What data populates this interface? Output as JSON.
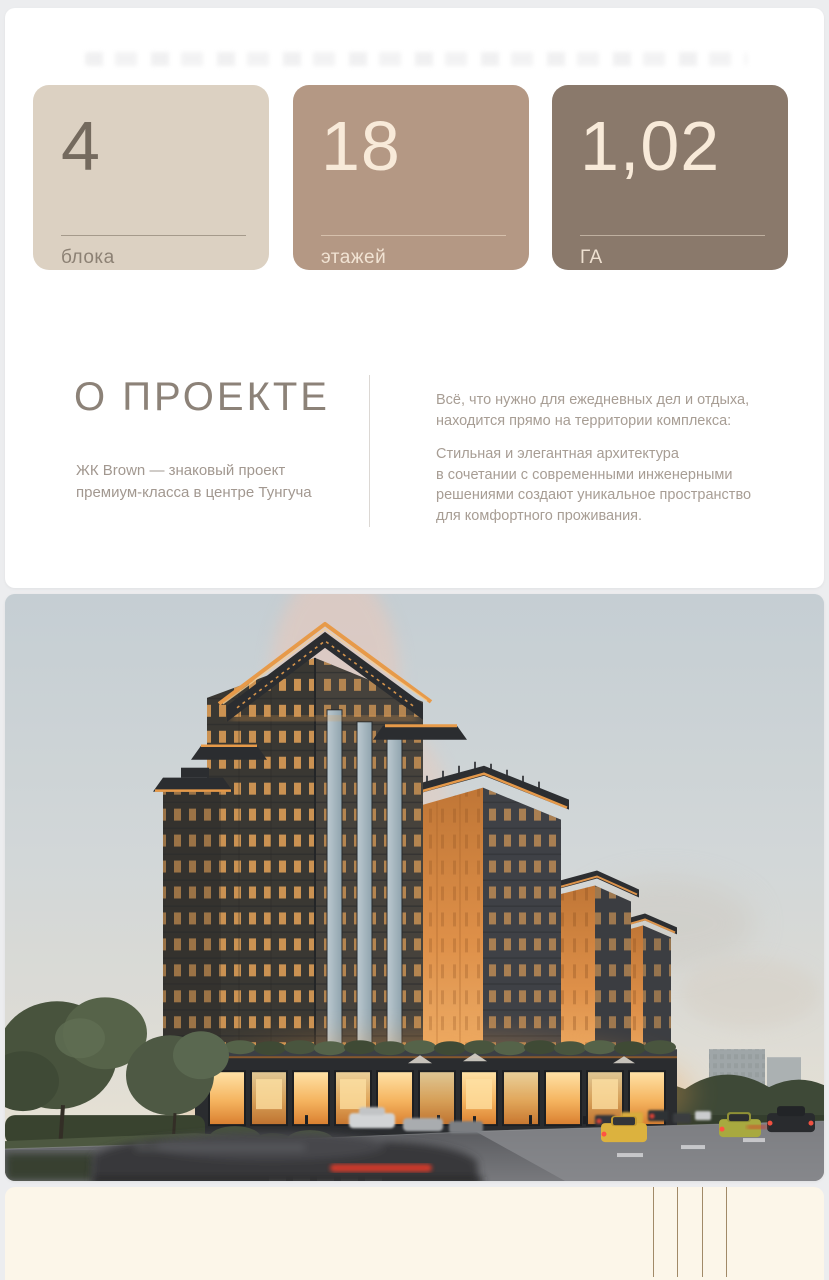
{
  "theme": {
    "page_bg": "#ecedef",
    "panel_bg": "#ffffff",
    "footer_bg": "#fcf6e9",
    "footer_line_color": "#a18a68",
    "divider_color": "#dcd8d4",
    "heading_color": "#8c8278",
    "body_text_color": "#a79d94",
    "accent_orange": "#e89b4c"
  },
  "stats": {
    "cards": [
      {
        "value": "4",
        "label": "блока",
        "bg": "#dcd1c2",
        "value_color": "#746a5e",
        "label_color": "#8c8174",
        "divider_color": "#a59a8b"
      },
      {
        "value": "18",
        "label": "этажей",
        "bg": "#b49884",
        "value_color": "#f8ead9",
        "label_color": "#f1e3d3",
        "divider_color": "#d6c0ac"
      },
      {
        "value": "1,02",
        "label": "ГА",
        "bg": "#8a796b",
        "value_color": "#f8ead9",
        "label_color": "#eee0d0",
        "divider_color": "#bfb0a0"
      }
    ]
  },
  "about": {
    "title": "О ПРОЕКТЕ",
    "subtitle": "ЖК Brown — знаковый проект\nпремиум-класса в центре Тунгуча",
    "paragraph1": "Всё, что нужно для ежедневных дел и отдыха,\nнаходится прямо на территории комплекса:",
    "paragraph2": "Стильная и элегантная архитектура\nв сочетании с современными инженерными\nрешениями создают уникальное пространство\nдля комфортного проживания."
  }
}
